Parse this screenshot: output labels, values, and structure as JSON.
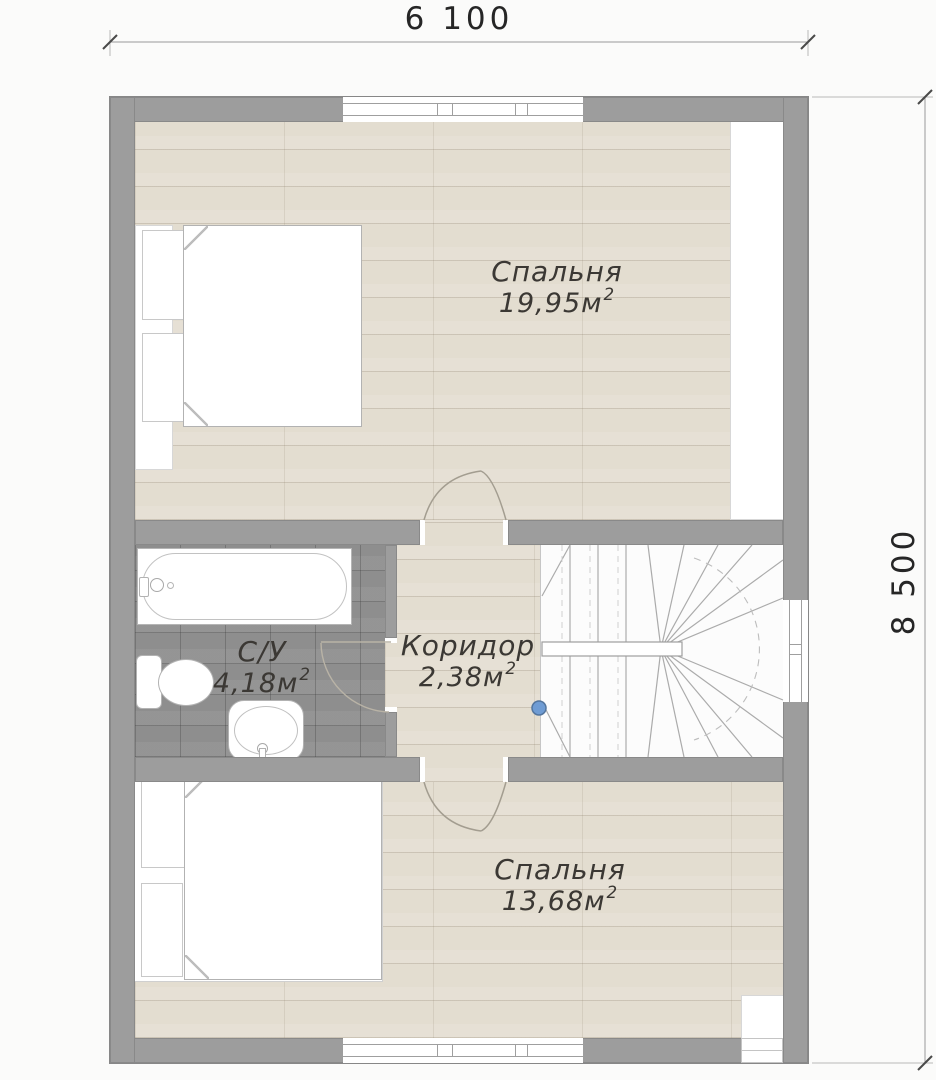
{
  "dimensions": {
    "top": "6 100",
    "right": "8 500"
  },
  "rooms": [
    {
      "id": "bedroom-top",
      "name": "Спальня",
      "area": "19,95м",
      "area_sup": "2"
    },
    {
      "id": "bathroom",
      "name": "С/У",
      "area": "4,18м",
      "area_sup": "2"
    },
    {
      "id": "corridor",
      "name": "Коридор",
      "area": "2,38м",
      "area_sup": "2"
    },
    {
      "id": "bedroom-bottom",
      "name": "Спальня",
      "area": "13,68м",
      "area_sup": "2"
    }
  ],
  "colors": {
    "wall": "#9d9d9d",
    "wood_floor": "#e3ddd0",
    "tile_floor": "#8e8e8e",
    "stair_floor": "#fcfcfc",
    "marker_dot": "#6f9cd4",
    "dimension_text": "#262626",
    "label_text": "#3b3834"
  }
}
